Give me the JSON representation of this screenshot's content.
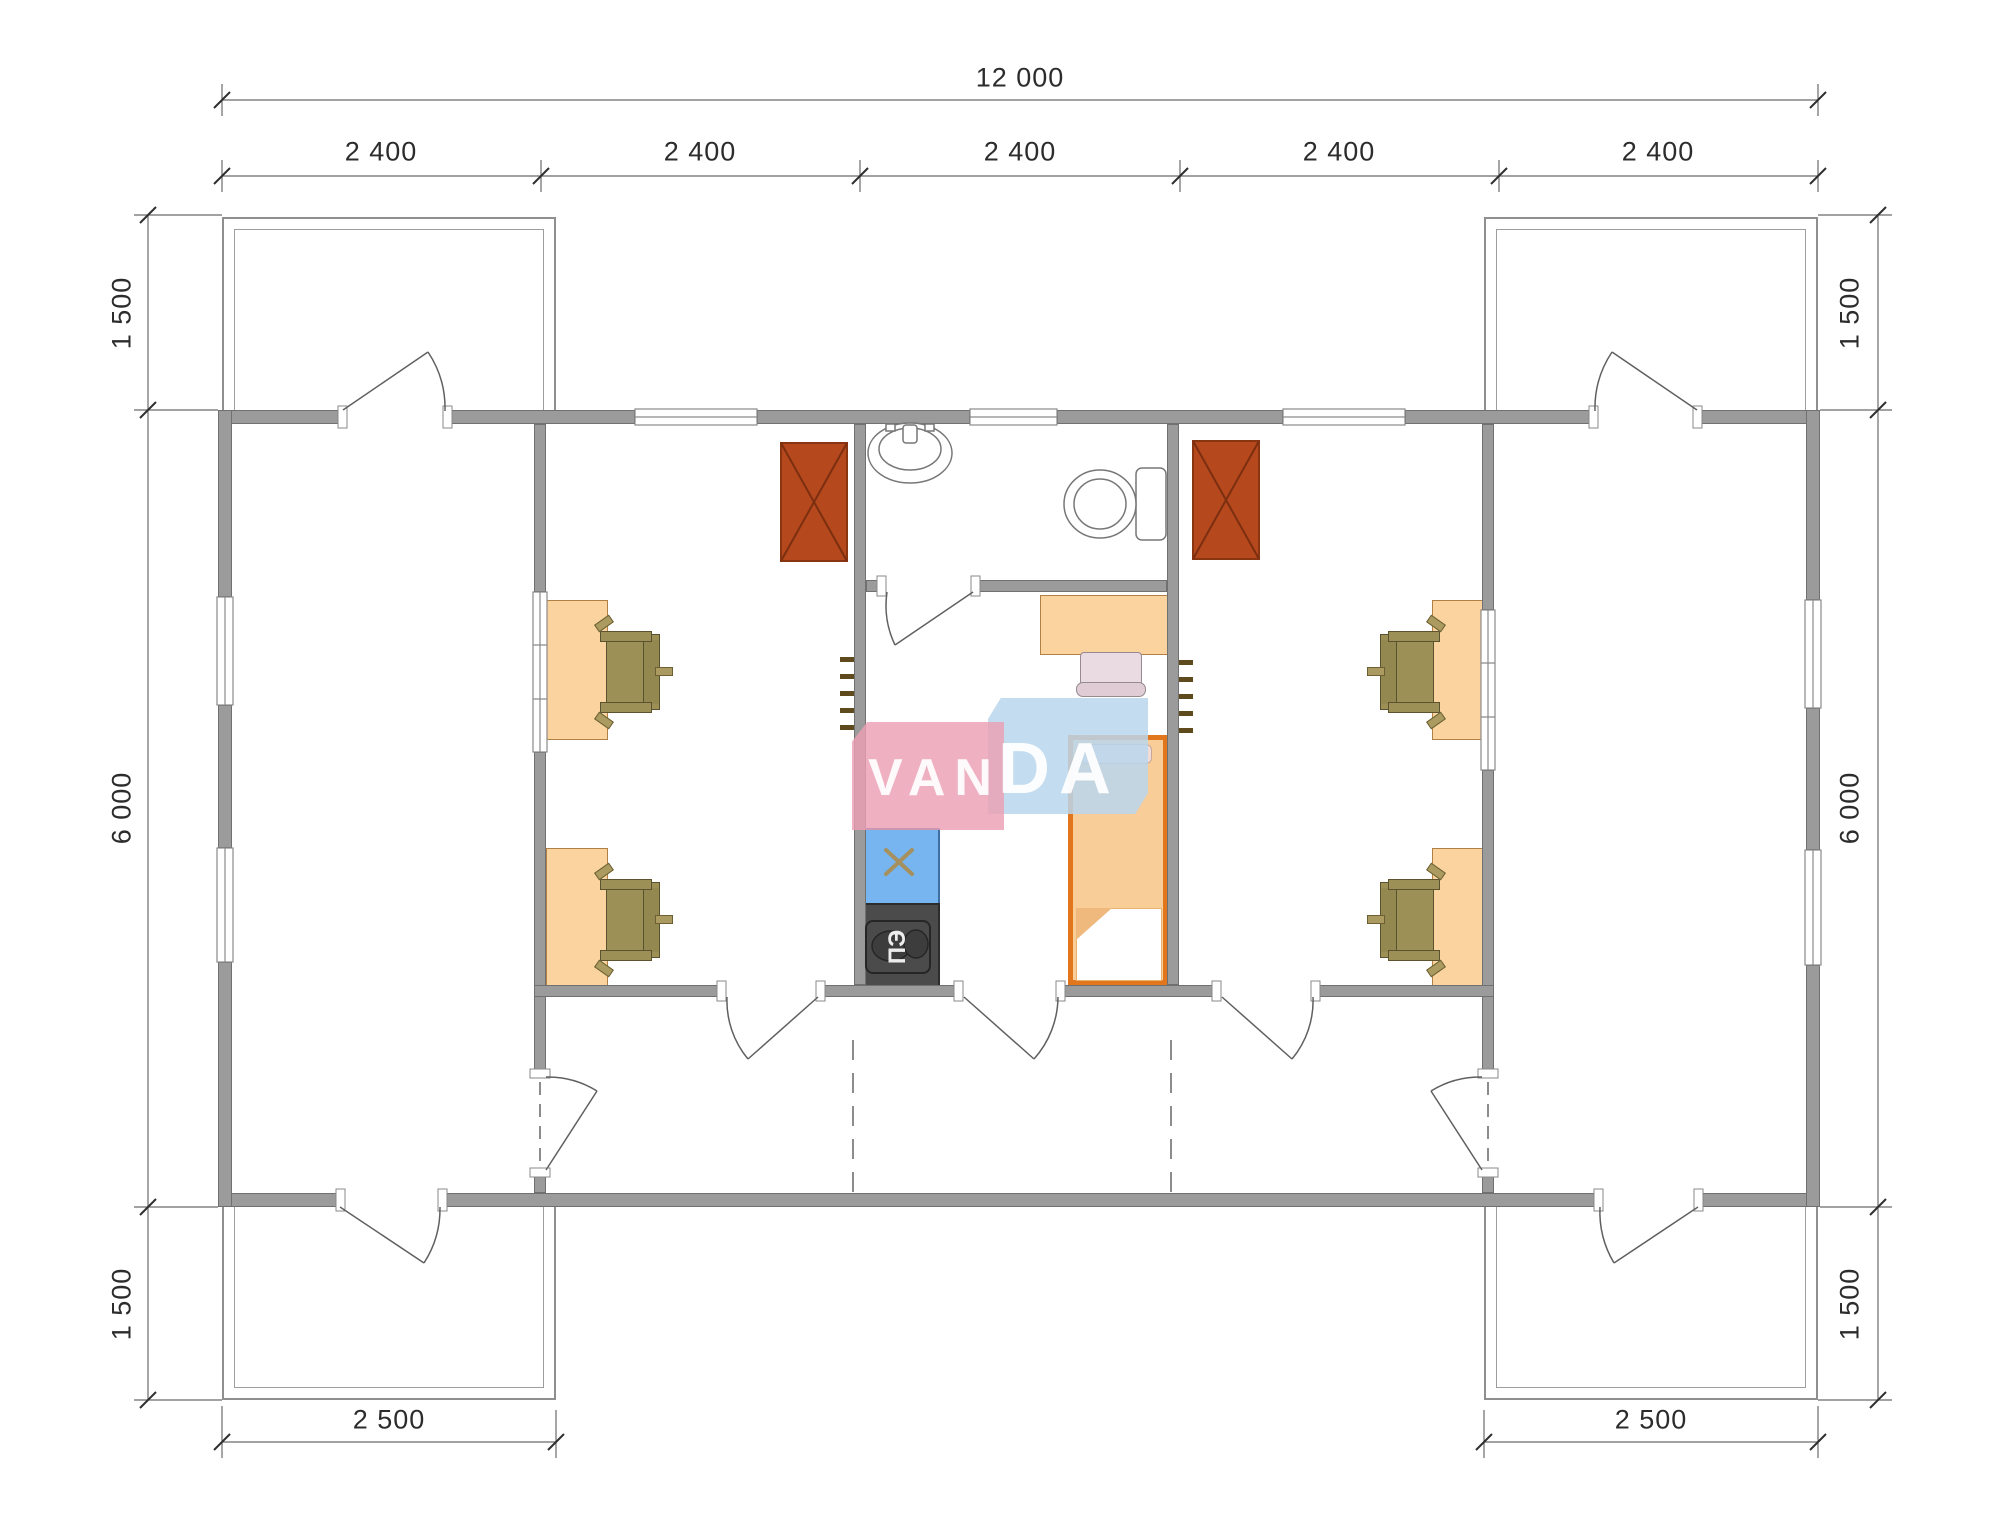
{
  "document": {
    "type": "architectural-floor-plan",
    "units": "mm",
    "description": "Modular building floor plan 12000 x 6000 with two offices, central kitchen/bedroom unit, bathroom, two entry rooms and four terraces"
  },
  "watermark": {
    "full": "VANDA",
    "part1": "VAN",
    "part2": "DA",
    "pink": "#f3b6c3",
    "blue": "#c8dcee",
    "text_color": "#ffffff"
  },
  "dimensions": {
    "top_total": "12 000",
    "top_segments": [
      "2 400",
      "2 400",
      "2 400",
      "2 400",
      "2 400"
    ],
    "left_top": "1 500",
    "left_middle": "6 000",
    "left_bottom": "1 500",
    "right_top": "1 500",
    "right_middle": "6 000",
    "right_bottom": "1 500",
    "bottom_left": "2 500",
    "bottom_right": "2 500"
  },
  "appliances": {
    "electric_stove_label": "ПЭ"
  },
  "fixtures": {
    "icons": [
      "sink-icon",
      "toilet-icon",
      "wood-stove-icon",
      "coat-hooks-icon",
      "kitchen-sink-icon",
      "electric-stove-icon",
      "bed-icon",
      "desk-icon",
      "office-chair-icon",
      "door-swing-icon",
      "window-icon"
    ]
  },
  "colors": {
    "wall": "#9b9b9b",
    "wall_edge": "#707070",
    "wood_stove": "#b5481c",
    "furniture_peach": "#fbd39e",
    "bed_border": "#e2761d",
    "chair_olive": "#9c9057",
    "counter_blue": "#76b5ef",
    "stove_dark": "#4b4b4b",
    "linework": "#606060",
    "dimension_text": "#2c2c2c"
  }
}
